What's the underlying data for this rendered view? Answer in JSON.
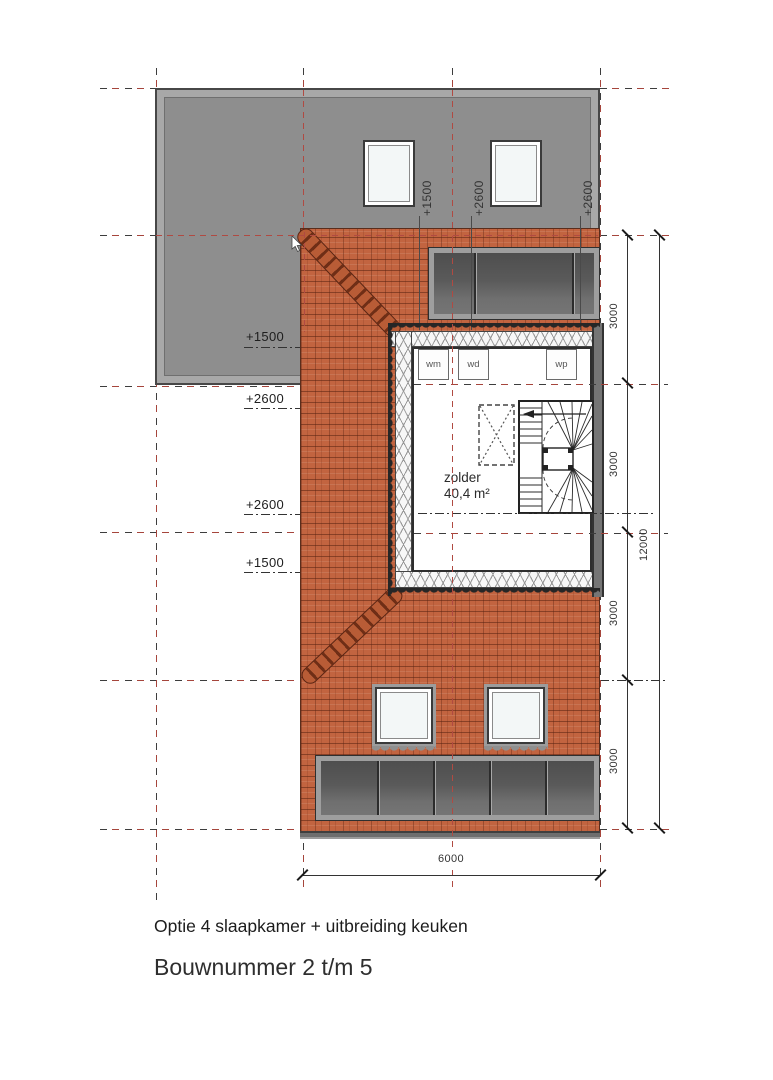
{
  "plan": {
    "room_label": "zolder",
    "room_area": "40,4 m²",
    "appliances": [
      "wm",
      "wd",
      "wp"
    ],
    "height_labels_left": [
      "+1500",
      "+2600",
      "+2600",
      "+1500"
    ],
    "height_labels_roof": [
      "+1500",
      "+2600",
      "+2600"
    ]
  },
  "dimensions": {
    "right_segments": [
      "3000",
      "3000",
      "3000",
      "3000"
    ],
    "right_total": "12000",
    "bottom_width": "6000"
  },
  "footer": {
    "option_text": "Optie 4 slaapkamer + uitbreiding keuken",
    "title_text": "Bouwnummer 2 t/m 5"
  },
  "colors": {
    "tile": "#c26440",
    "roof_gray": "#8e8e8e",
    "grid_red": "#a6453c",
    "glass_dark": "#4e4e4e"
  }
}
